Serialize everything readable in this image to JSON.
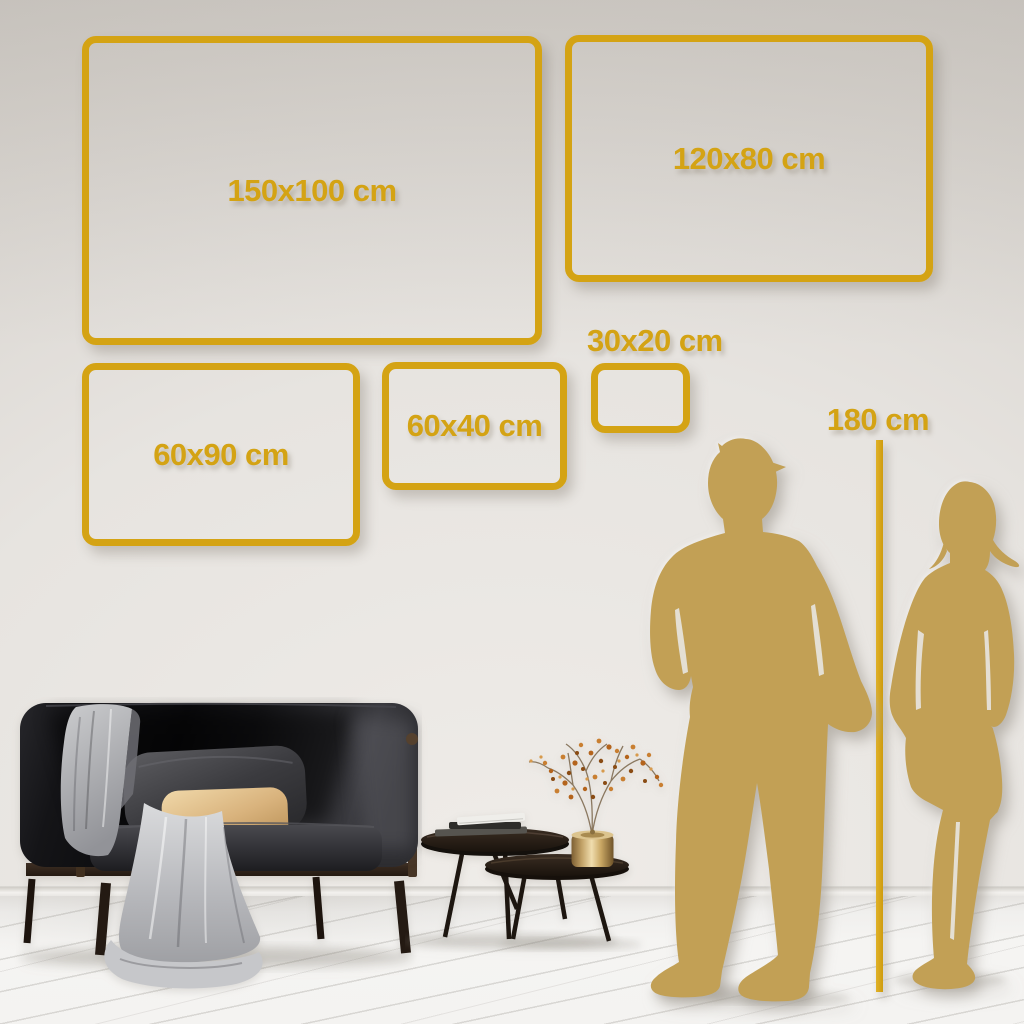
{
  "size_guide": {
    "frames": [
      {
        "id": "150x100",
        "label": "150x100 cm",
        "width_cm": 150,
        "height_cm": 100
      },
      {
        "id": "120x80",
        "label": "120x80 cm",
        "width_cm": 120,
        "height_cm": 80
      },
      {
        "id": "60x90",
        "label": "60x90 cm",
        "width_cm": 60,
        "height_cm": 90
      },
      {
        "id": "60x40",
        "label": "60x40 cm",
        "width_cm": 60,
        "height_cm": 40
      },
      {
        "id": "30x20",
        "label": "30x20 cm",
        "width_cm": 30,
        "height_cm": 20
      }
    ],
    "height_reference": {
      "label": "180 cm",
      "height_cm": 180
    }
  },
  "colors": {
    "gold": "#d4a314",
    "silhouette": "#c2a055",
    "wall": "#dedad5",
    "floor": "#f4f3f1"
  }
}
